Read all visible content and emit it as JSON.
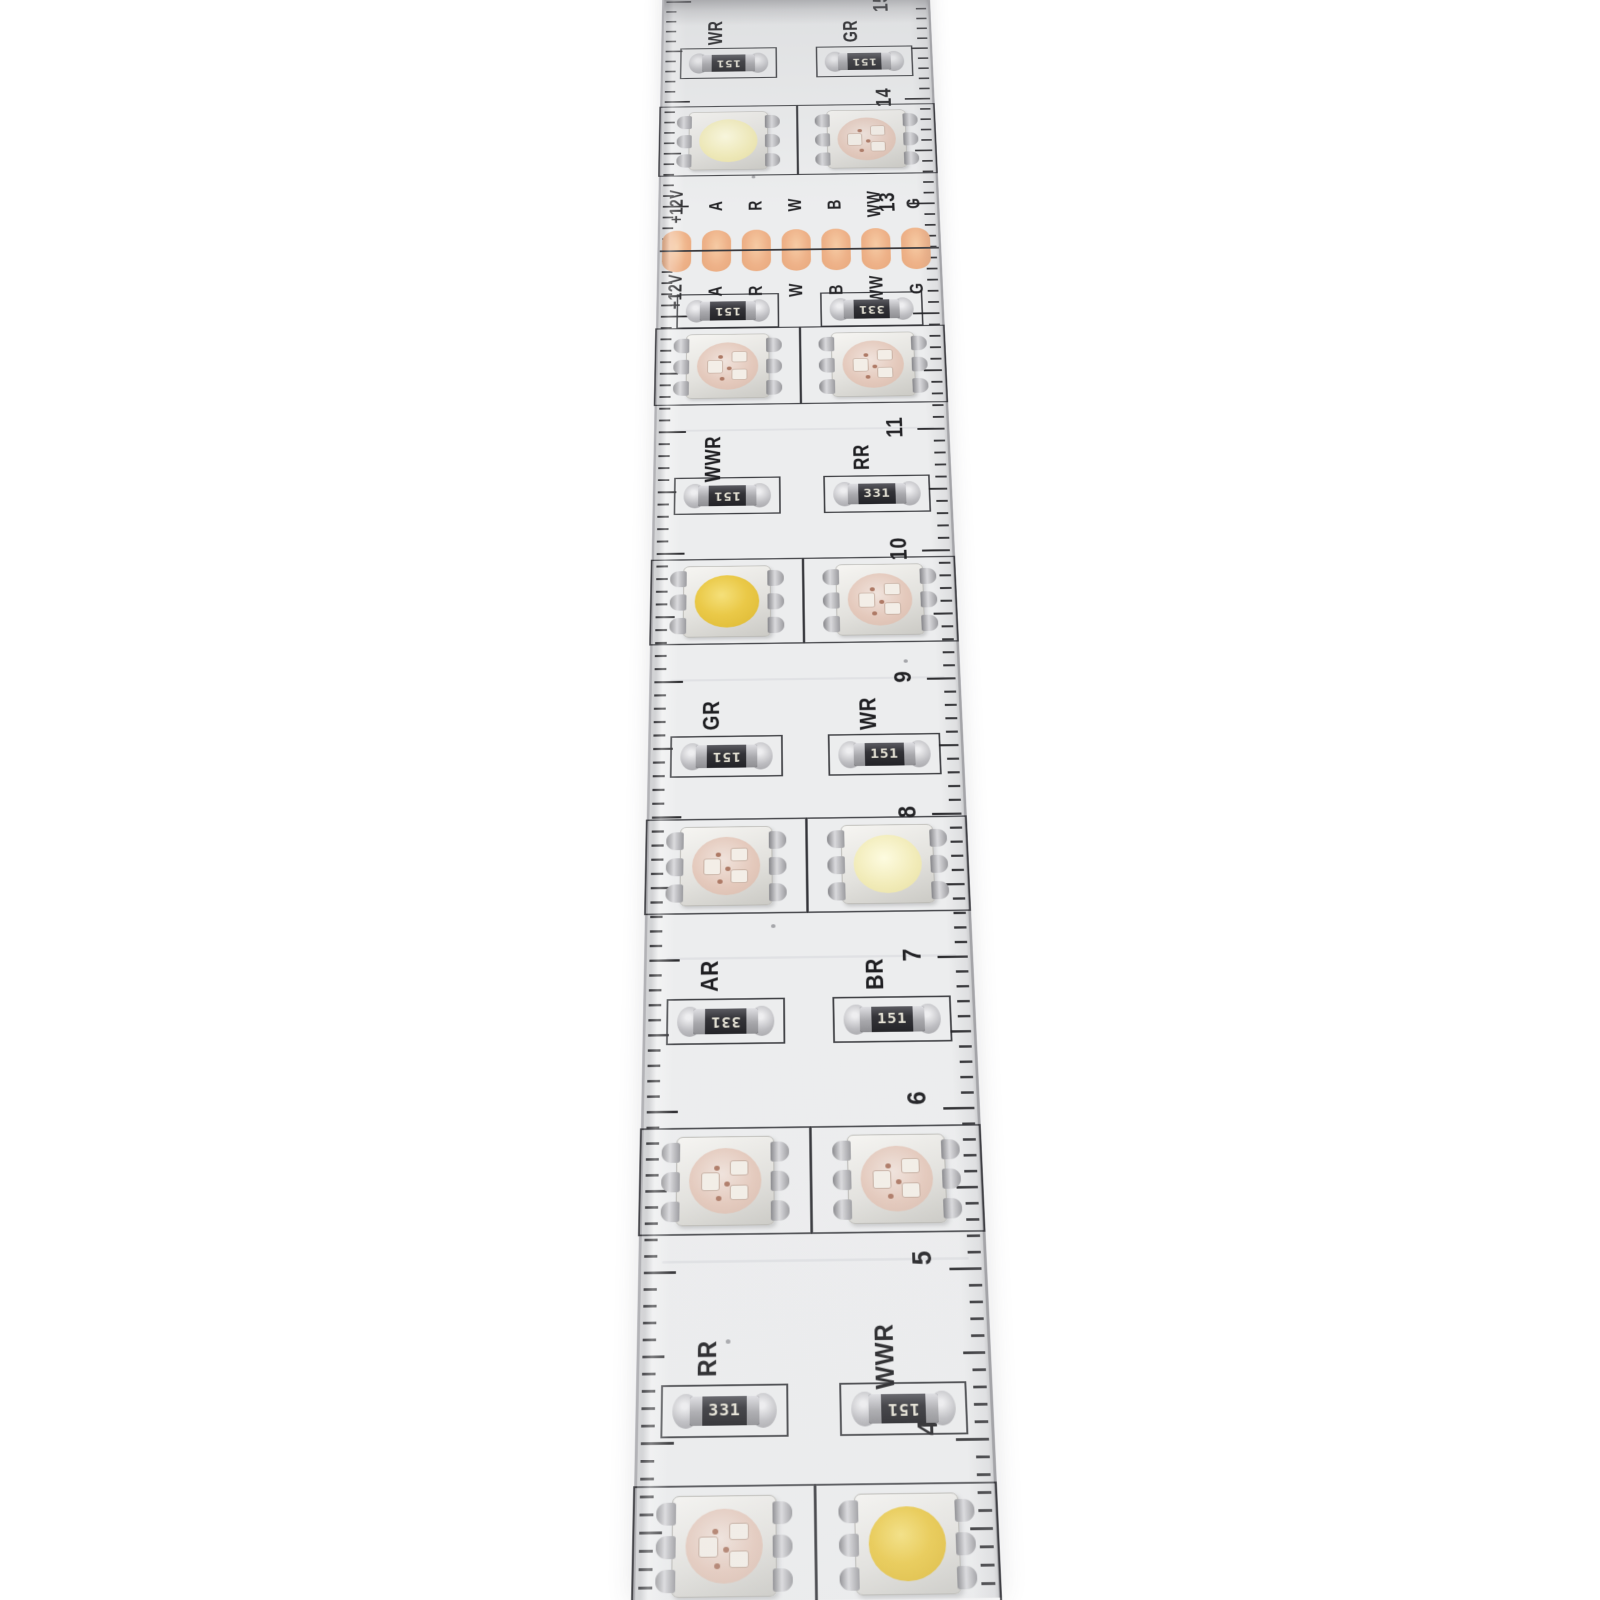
{
  "strip": {
    "ruler_numbers": [
      "15",
      "14",
      "13",
      "11",
      "10",
      "9",
      "8",
      "7",
      "6",
      "5",
      "4"
    ],
    "solder_pads": {
      "labels_top": [
        "+12V",
        "A",
        "R",
        "W",
        "B",
        "WW",
        "G"
      ],
      "labels_bottom": [
        "+12V",
        "A",
        "R",
        "W",
        "B",
        "WW",
        "G"
      ]
    },
    "rows": [
      {
        "type": "resistor-pair",
        "left": {
          "label": "WR",
          "value": "151",
          "flipped": true
        },
        "right": {
          "label": "GR",
          "value": "151",
          "flipped": true
        }
      },
      {
        "type": "led-pair",
        "left": {
          "kind": "cool-white"
        },
        "right": {
          "kind": "rgb"
        }
      },
      {
        "type": "pads"
      },
      {
        "type": "resistor-pair",
        "label_position": "below",
        "left": {
          "label": "BR",
          "value": "151",
          "flipped": true
        },
        "right": {
          "label": "AR",
          "value": "331",
          "flipped": true
        }
      },
      {
        "type": "led-pair",
        "left": {
          "kind": "rgb"
        },
        "right": {
          "kind": "rgb"
        }
      },
      {
        "type": "resistor-pair",
        "left": {
          "label": "WWR",
          "value": "151",
          "flipped": true
        },
        "right": {
          "label": "RR",
          "value": "331",
          "flipped": false
        }
      },
      {
        "type": "led-pair",
        "left": {
          "kind": "warm-white"
        },
        "right": {
          "kind": "rgb"
        }
      },
      {
        "type": "resistor-pair",
        "left": {
          "label": "GR",
          "value": "151",
          "flipped": true
        },
        "right": {
          "label": "WR",
          "value": "151",
          "flipped": false
        }
      },
      {
        "type": "led-pair",
        "left": {
          "kind": "rgb"
        },
        "right": {
          "kind": "cool-white"
        }
      },
      {
        "type": "resistor-pair",
        "left": {
          "label": "AR",
          "value": "331",
          "flipped": true
        },
        "right": {
          "label": "BR",
          "value": "151",
          "flipped": false
        }
      },
      {
        "type": "led-pair",
        "left": {
          "kind": "rgb"
        },
        "right": {
          "kind": "rgb"
        }
      },
      {
        "type": "resistor-pair",
        "left": {
          "label": "RR",
          "value": "331",
          "flipped": false
        },
        "right": {
          "label": "WWR",
          "value": "151",
          "flipped": true
        }
      },
      {
        "type": "led-pair",
        "left": {
          "kind": "rgb"
        },
        "right": {
          "kind": "warm-white"
        }
      }
    ],
    "colors": {
      "pcb": "#ecedee",
      "silkscreen": "#2e2e31",
      "copper_pad": "#eeb289",
      "warm_white_lens": "#eac948",
      "cool_white_lens": "#f2ecba",
      "rgb_lens": "#e4c9bc",
      "resistor_body": "#333338",
      "background": "#ffffff"
    }
  }
}
